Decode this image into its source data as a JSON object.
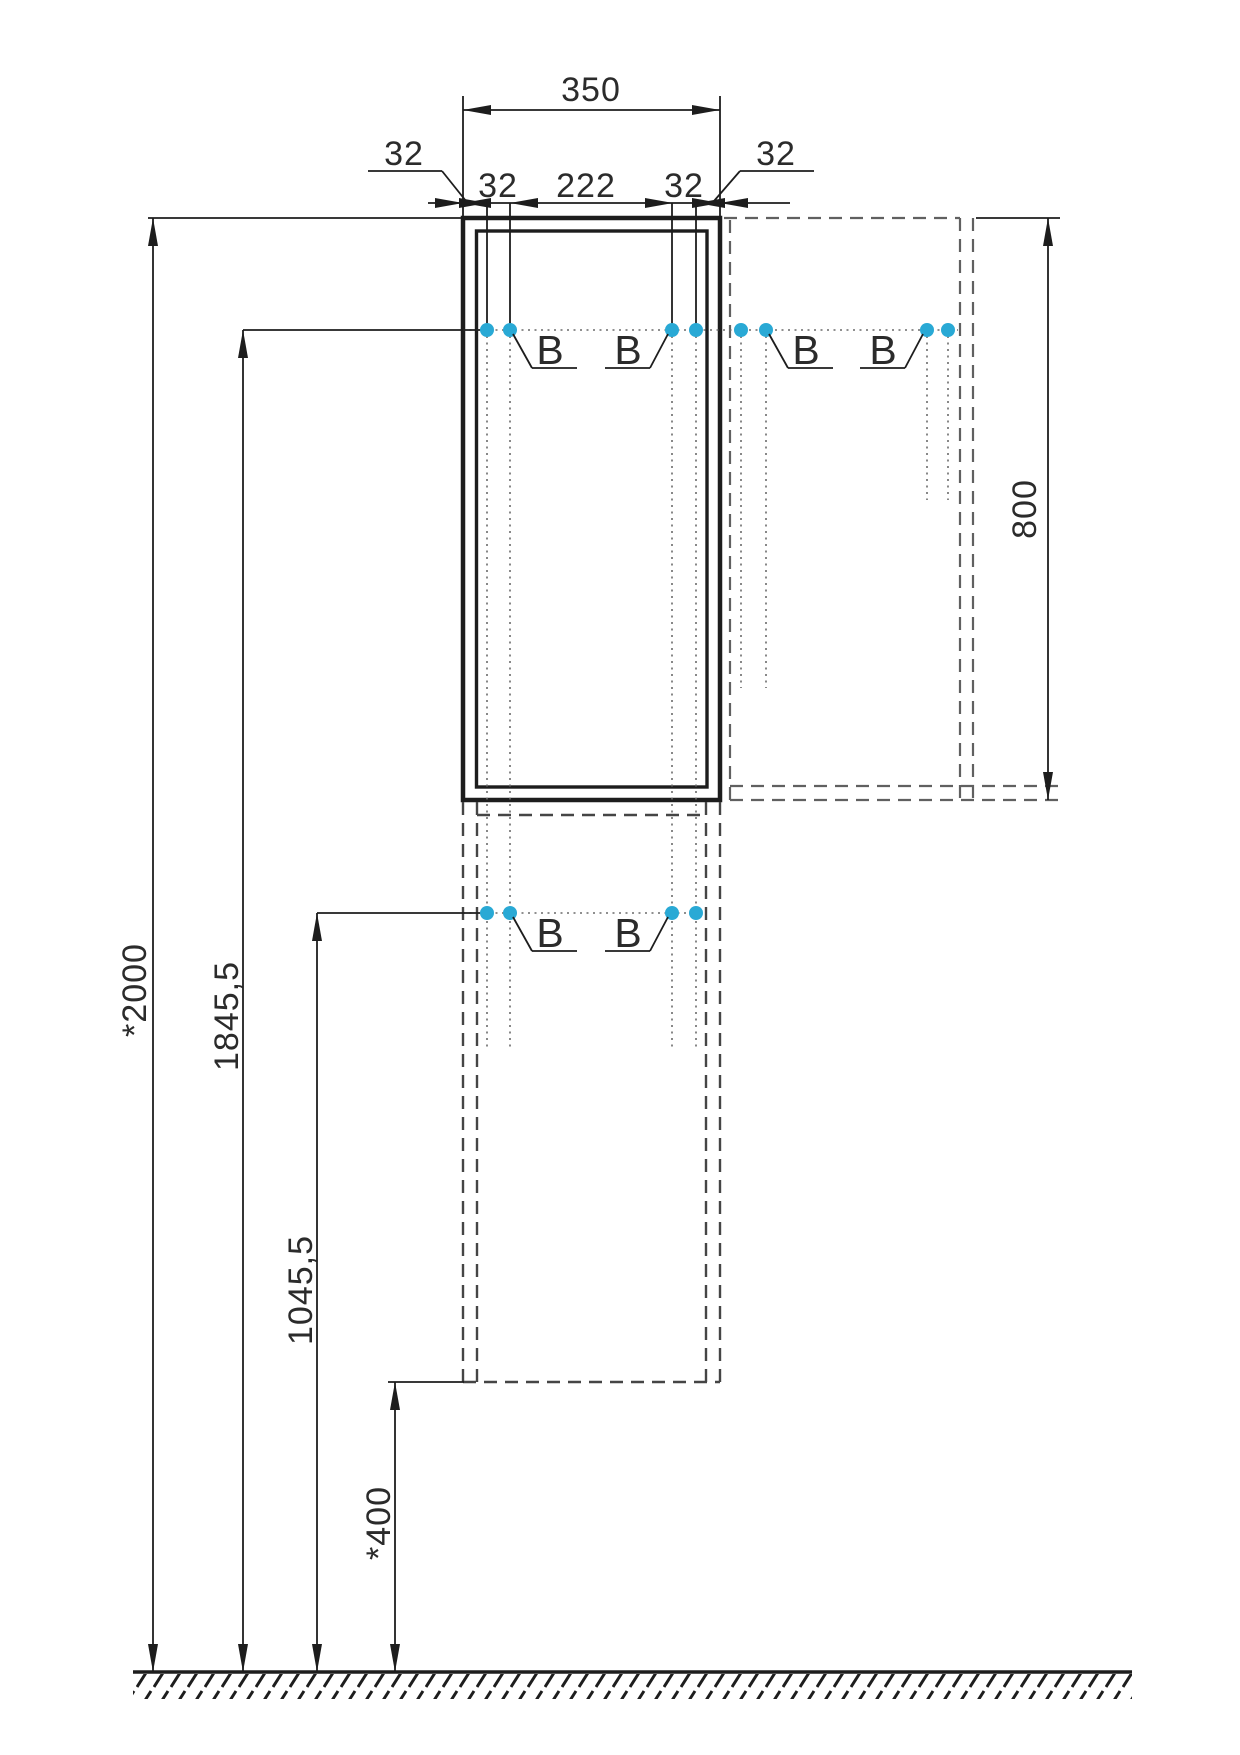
{
  "drawing": {
    "type": "cabinet-installation-dimension-diagram",
    "dims": {
      "top_width": "350",
      "row_left_leader": "32",
      "row_left": "32",
      "row_center": "222",
      "row_right": "32",
      "row_right_leader": "32",
      "side_height": "800",
      "total_height": "*2000",
      "upper_holes": "1845,5",
      "lower_holes": "1045,5",
      "floor_offset": "*400"
    },
    "hole_label": "B",
    "colors": {
      "line": "#1d1d1d",
      "dashed_outline": "#606060",
      "hole_dot": "#29a9d5"
    }
  }
}
